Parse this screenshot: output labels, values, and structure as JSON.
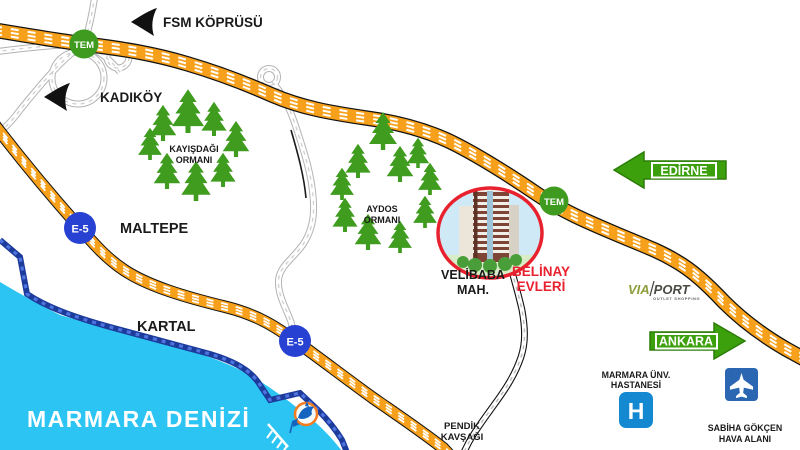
{
  "colors": {
    "sea": "#2BC4F3",
    "highway": "#F7A01B",
    "road_blue": "#1C3B9B",
    "badge_tem": "#3E9B1F",
    "badge_e5": "#2741D2",
    "arrow_green": "#3CA00C",
    "accent_red": "#E8212E",
    "forest_green": "#3F9C1F",
    "hospital_blue": "#1489D2",
    "airport_blue": "#2A66B2"
  },
  "badges": {
    "tem": "TEM",
    "e5": "E-5"
  },
  "directions": {
    "fsm_bridge": "FSM KÖPRÜSÜ",
    "kadikoy": "KADIKÖY",
    "edirne": "EDİRNE",
    "ankara": "ANKARA"
  },
  "districts": {
    "maltepe": "MALTEPE",
    "kartal": "KARTAL"
  },
  "sea": {
    "label": "MARMARA DENİZİ"
  },
  "forests": {
    "kayisdagi": {
      "line1": "KAYIŞDAĞI",
      "line2": "ORMANI"
    },
    "aydos": {
      "line1": "AYDOS",
      "line2": "ORMANI"
    }
  },
  "project": {
    "neighborhood_line1": "VELİBABA",
    "neighborhood_line2": "MAH.",
    "name_line1": "BELİNAY",
    "name_line2": "EVLERİ"
  },
  "landmarks": {
    "viaport": {
      "part1": "VIA",
      "part2": "PORT",
      "subtitle": "OUTLET SHOPPING"
    },
    "hospital": {
      "line1": "MARMARA ÜNV.",
      "line2": "HASTANESİ",
      "sign": "H"
    },
    "airport": {
      "line1": "SABİHA GÖKÇEN",
      "line2": "HAVA ALANI"
    },
    "junction": {
      "line1": "PENDİK",
      "line2": "KAVŞAĞI"
    }
  }
}
